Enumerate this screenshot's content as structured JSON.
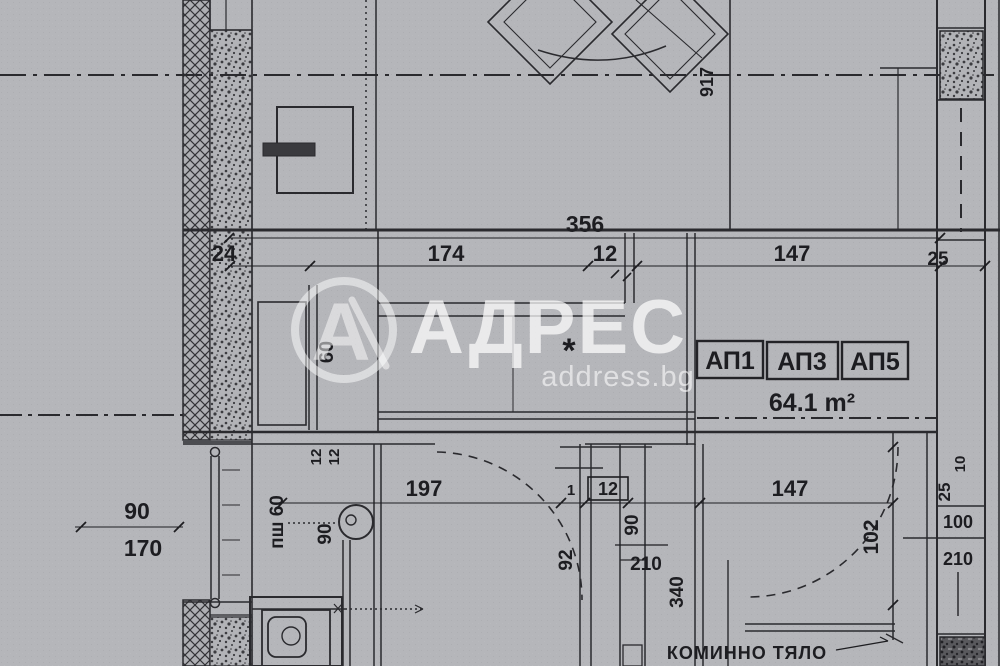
{
  "watermark": {
    "logo_letter": "А",
    "brand": "АДРЕС",
    "site": "address.bg"
  },
  "plan": {
    "unit_1": "АП1",
    "unit_2": "АП3",
    "unit_3": "АП5",
    "area": "64.1 m²",
    "chimney_label": "КОМИННО ТЯЛО",
    "room_marker": "*"
  },
  "dims": {
    "total_width": "356",
    "seg_24": "24",
    "seg_174": "174",
    "seg_12": "12",
    "seg_147": "147",
    "seg_25": "25",
    "vert_917": "917",
    "closet_60": "60",
    "outer_90": "90",
    "outer_170": "170",
    "mid_197": "197",
    "mid_1": "1",
    "mid_12_boxed": "12",
    "mid_147": "147",
    "wall_12_a": "12",
    "wall_12_b": "12",
    "slide_door_label": "пш 60",
    "kitchen_door_90": "90",
    "bath_92": "92",
    "wc_door_90": "90",
    "wc_door_210": "210",
    "vert_340": "340",
    "hall_102": "102",
    "col_10": "10",
    "col_25": "25",
    "entry_door_100": "100",
    "entry_door_210": "210"
  },
  "colors": {
    "paper": "#b5b6ba",
    "ink": "#2a2a2e",
    "watermark": "#ffffff"
  }
}
